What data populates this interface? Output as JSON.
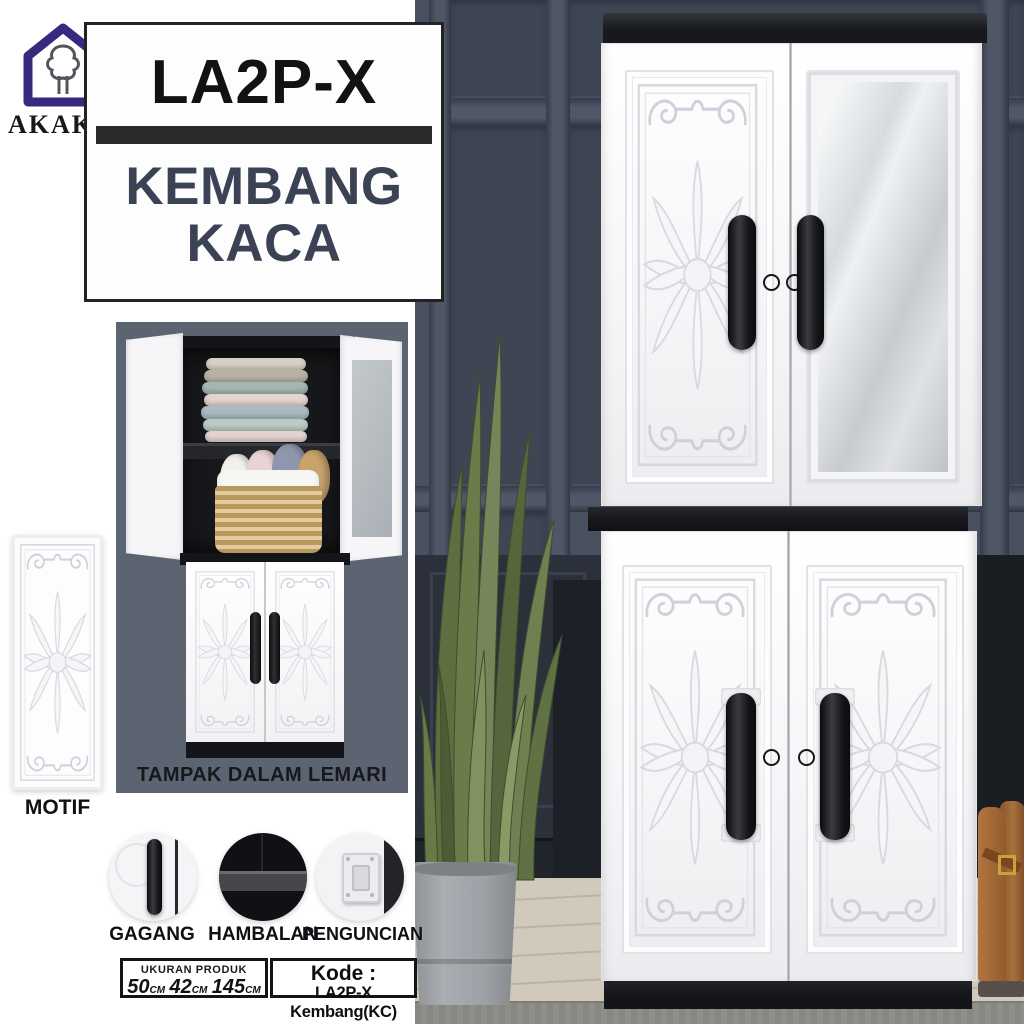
{
  "brand": {
    "name": "AKAKO",
    "registered": "®",
    "logo": "house-with-tree"
  },
  "title": {
    "model": "LA2P-X",
    "line1": "KEMBANG",
    "line2": "KACA"
  },
  "inset": {
    "caption": "TAMPAK DALAM LEMARI"
  },
  "motif": {
    "label": "MOTIF"
  },
  "features": [
    {
      "label": "GAGANG"
    },
    {
      "label": "HAMBALAN"
    },
    {
      "label": "PENGUNCIAN"
    }
  ],
  "size_box": {
    "heading": "UKURAN PRODUK",
    "dims": [
      {
        "value": "50",
        "unit": "CM"
      },
      {
        "value": "42",
        "unit": "CM"
      },
      {
        "value": "145",
        "unit": "CM"
      }
    ]
  },
  "code_box": {
    "heading": "Kode :",
    "code": "LA2P-X Kembang(KC)"
  },
  "colors": {
    "brand_purple": "#362a7e",
    "title_navy": "#3a4254",
    "bar_black": "#2b2b2b",
    "wall_gray": "#49505f",
    "inset_gray": "#5d6471",
    "cabinet_white": "#f7f7f9",
    "accent_black": "#17191c",
    "floor_wood": "#d0c9bc",
    "rug_gray": "#8f8e89",
    "plant_green": "#6b7c4a",
    "boot_brown": "#a8713f"
  }
}
